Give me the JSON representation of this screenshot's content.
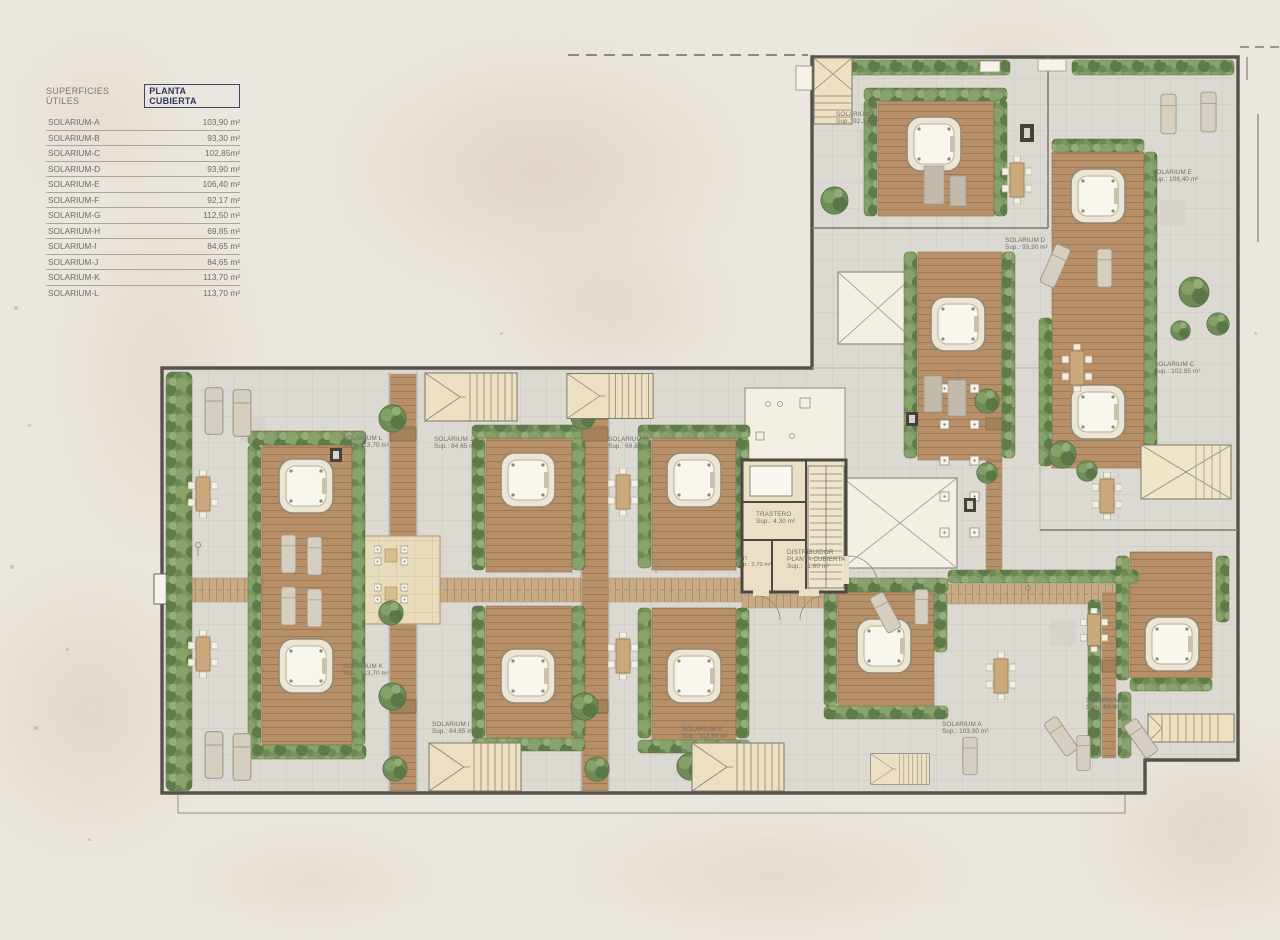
{
  "legend": {
    "title": "SUPERFICIES ÚTILES",
    "plan_name": "PLANTA CUBIERTA",
    "rows": [
      {
        "label": "SOLARIUM-A",
        "value": "103,90 m²"
      },
      {
        "label": "SOLARIUM-B",
        "value": "93,30 m²"
      },
      {
        "label": "SOLARIUM-C",
        "value": "102,85m²"
      },
      {
        "label": "SOLARIUM-D",
        "value": "93,90 m²"
      },
      {
        "label": "SOLARIUM-E",
        "value": "106,40 m²"
      },
      {
        "label": "SOLARIUM-F",
        "value": "92,17 m²"
      },
      {
        "label": "SOLARIUM-G",
        "value": "112,50 m²"
      },
      {
        "label": "SOLARIUM-H",
        "value": "69,85 m²"
      },
      {
        "label": "SOLARIUM-I",
        "value": "84,65 m²"
      },
      {
        "label": "SOLARIUM-J",
        "value": "84,65 m²"
      },
      {
        "label": "SOLARIUM-K",
        "value": "113,70 m²"
      },
      {
        "label": "SOLARIUM-L",
        "value": "113,70 m²"
      }
    ]
  },
  "plan": {
    "labels": [
      {
        "name": "SOLARIUM F",
        "sup": "Sup.: 92,17 m²"
      },
      {
        "name": "SOLARIUM E",
        "sup": "Sup.: 106,40 m²"
      },
      {
        "name": "SOLARIUM D",
        "sup": "Sup.: 93,90 m²"
      },
      {
        "name": "SOLARIUM C",
        "sup": "Sup.: 102,85 m²"
      },
      {
        "name": "SOLARIUM L",
        "sup": "Sup.: 113,70 m²"
      },
      {
        "name": "SOLARIUM J",
        "sup": "Sup.: 84,65 m²"
      },
      {
        "name": "SOLARIUM H",
        "sup": "Sup.: 69,85 m²"
      },
      {
        "name": "SOLARIUM K",
        "sup": "Sup.: 113,70 m²"
      },
      {
        "name": "SOLARIUM I",
        "sup": "Sup.: 84,65 m²"
      },
      {
        "name": "SOLARIUM G",
        "sup": "Sup.: 112,50 m²"
      },
      {
        "name": "SOLARIUM A",
        "sup": "Sup.: 103,90 m²"
      },
      {
        "name": "SOLARIUM B",
        "sup": "Sup.: 93,30 m²"
      }
    ],
    "core": {
      "trastero": {
        "name": "TRASTERO",
        "sup": "Sup.: 4,30 m²"
      },
      "riti": {
        "name": "RITI",
        "sup": "Sup.: 2,70 m²"
      },
      "distribuidor": {
        "line1": "DISTRIBUIDOR",
        "line2": "PLANTA CUBIERTA",
        "line3": "Sup.: 11,60 m²"
      }
    }
  },
  "colors": {
    "plan_name_navy": "#2a3563",
    "ink": "#6e6c66",
    "paper": "#ece7de",
    "deck_wood": "#b78f68",
    "hedge_green": "#7a9560",
    "wall": "#55514b"
  }
}
